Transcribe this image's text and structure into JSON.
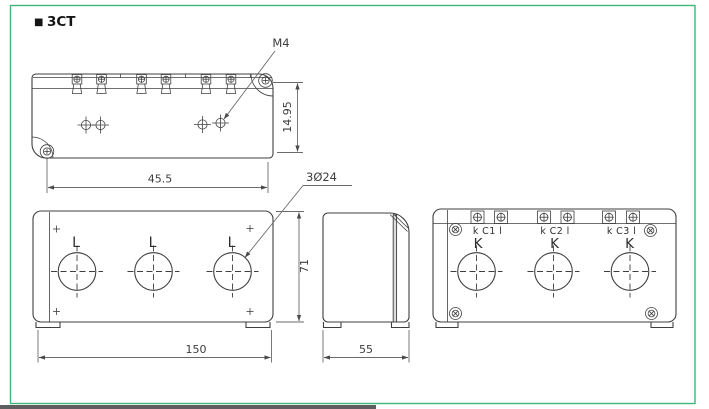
{
  "colors": {
    "border": "#3cb878",
    "line": "#3f3f3f",
    "dim": "#6a6a6a",
    "text": "#333333",
    "background": "#ffffff",
    "scrollbar": "#5e5e5e"
  },
  "title": {
    "bullet": "■",
    "text": "3CT"
  },
  "top_view": {
    "screw_callout": "M4",
    "dim_vertical": "14.95",
    "dim_horizontal": "45.5"
  },
  "front_view": {
    "hole_labels": [
      "L",
      "L",
      "L"
    ],
    "hole_callout": "3Ø24",
    "dim_width": "150",
    "dim_height": "71"
  },
  "side_view": {
    "dim_width": "55"
  },
  "back_view": {
    "terminal_labels": [
      "k C1 l",
      "k C2 l",
      "k C3 l"
    ],
    "k_labels": [
      "K",
      "K",
      "K"
    ]
  }
}
